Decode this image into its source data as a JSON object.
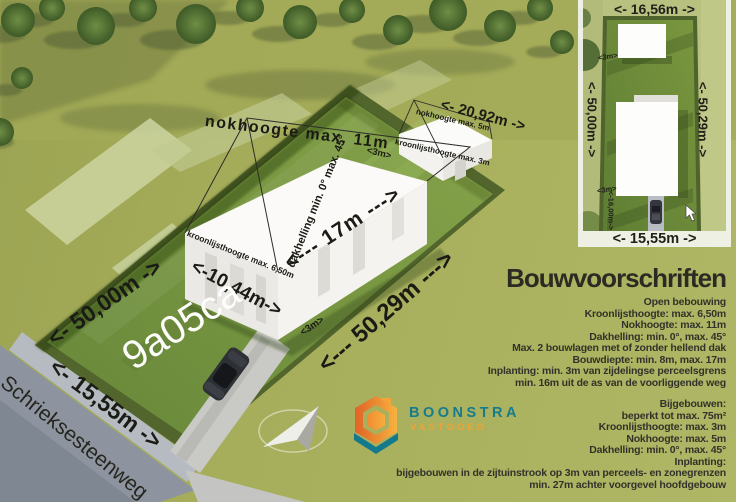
{
  "scene": {
    "plot_code": "9a05ca",
    "street_name": "Schrieksesteenweg",
    "labels": {
      "ridge_height_main": "nokhoogte max. 11m",
      "roof_pitch_main": "dakhelling min. 0° max. 45°",
      "eaves_height_main": "kroonlijsthoogte max. 6,50m",
      "house_depth": "<--- 17m --->",
      "house_width": "<-10,44m->",
      "outbuilding_width": "<- 20,92m ->",
      "ridge_height_outbuilding": "nokhoogte max. 5m",
      "eaves_height_outbuilding": "kroonlijsthoogte max. 3m",
      "side_setback_top": "<3m>",
      "side_setback_bottom": "<3m>",
      "left_boundary_length": "<- 50,00m ->",
      "right_boundary_length": "<--- 50,29m --->",
      "front_width": "<- 15,55m ->"
    }
  },
  "plan": {
    "top_width": "<- 16,56m ->",
    "left_length": "<- 50,00m ->",
    "right_length": "<- 50,29m ->",
    "bottom_width": "<- 15,55m ->",
    "setback_top": "<3m>",
    "setback_bottom": "<3m>",
    "front_distance": "<-16,00m->"
  },
  "specs": {
    "title": "Bouwvoorschriften",
    "main_rules": [
      "Open bebouwing",
      "Kroonlijsthoogte: max. 6,50m",
      "Nokhoogte: max. 11m",
      "Dakhelling: min. 0°, max. 45°",
      "Max. 2 bouwlagen met of zonder hellend dak",
      "Bouwdiepte: min. 8m, max. 17m",
      "Inplanting: min. 3m van zijdelingse perceelsgrens",
      "min. 16m uit de as van de voorliggende weg"
    ],
    "secondary_rules": [
      "Bijgebouwen:",
      "beperkt tot max. 75m²",
      "Kroonlijsthoogte: max. 3m",
      "Nokhoogte: max. 5m",
      "Dakhelling: min. 0°, max. 45°",
      "Inplanting:",
      "bijgebouwen in de zijtuinstrook op 3m van perceels- en zonegrenzen",
      "min. 27m achter voorgevel hoofdgebouw"
    ]
  },
  "logo": {
    "brand": "BOONSTRA",
    "sub": "VASTGOED",
    "teal": "#157b8d",
    "orange": "#f0a13c"
  },
  "colors": {
    "grass_olive": "#aab25f",
    "plot_green": "#76953c",
    "hedge_green": "#51652c",
    "road_gray": "#8d94a0",
    "building_white": "#fbfaf8",
    "text_dark": "#2b2b24"
  }
}
